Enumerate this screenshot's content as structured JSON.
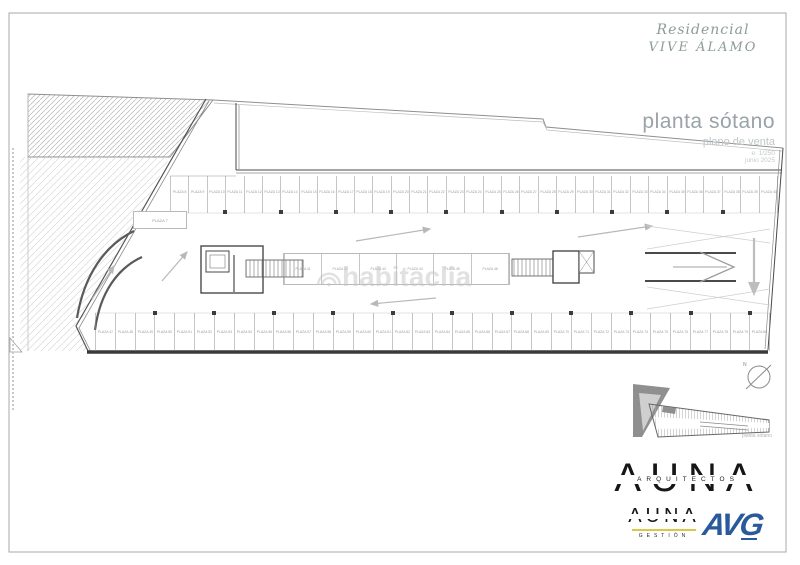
{
  "title_block": {
    "project_line1": "Residencial",
    "project_line2": "VIVE ÁLAMO",
    "plan_title": "planta sótano",
    "plan_subtitle": "plano de venta",
    "scale": "e: 1/250",
    "date": "junio 2025"
  },
  "watermark": {
    "text": "habitaclia"
  },
  "inset": {
    "caption": "planta sótano",
    "north_label": "N"
  },
  "logos": {
    "auna": {
      "name": "AUNA",
      "subtitle": "ARQUITECTOS"
    },
    "auna_gestion": {
      "name": "AUNA",
      "subtitle": "GESTIÓN"
    },
    "avg": {
      "name": "AVG"
    }
  },
  "plan": {
    "single_stall_label": "PLAZA 7",
    "top_row_labels": [
      "PLAZA 8",
      "PLAZA 9",
      "PLAZA 10",
      "PLAZA 11",
      "PLAZA 12",
      "PLAZA 13",
      "PLAZA 14",
      "PLAZA 15",
      "PLAZA 16",
      "PLAZA 17",
      "PLAZA 18",
      "PLAZA 19",
      "PLAZA 20",
      "PLAZA 21",
      "PLAZA 22",
      "PLAZA 23",
      "PLAZA 24",
      "PLAZA 25",
      "PLAZA 26",
      "PLAZA 27",
      "PLAZA 28",
      "PLAZA 29",
      "PLAZA 30",
      "PLAZA 31",
      "PLAZA 32",
      "PLAZA 33",
      "PLAZA 34",
      "PLAZA 35",
      "PLAZA 36",
      "PLAZA 37",
      "PLAZA 38",
      "PLAZA 39",
      "PLAZA 40"
    ],
    "middle_row_labels": [
      "PLAZA 41",
      "PLAZA 42",
      "PLAZA 43",
      "PLAZA 44",
      "PLAZA 45",
      "PLAZA 46"
    ],
    "bottom_row_labels": [
      "PLAZA 47",
      "PLAZA 48",
      "PLAZA 49",
      "PLAZA 50",
      "PLAZA 51",
      "PLAZA 52",
      "PLAZA 53",
      "PLAZA 54",
      "PLAZA 55",
      "PLAZA 56",
      "PLAZA 57",
      "PLAZA 58",
      "PLAZA 59",
      "PLAZA 60",
      "PLAZA 61",
      "PLAZA 62",
      "PLAZA 63",
      "PLAZA 64",
      "PLAZA 65",
      "PLAZA 66",
      "PLAZA 67",
      "PLAZA 68",
      "PLAZA 69",
      "PLAZA 70",
      "PLAZA 71",
      "PLAZA 72",
      "PLAZA 73",
      "PLAZA 74",
      "PLAZA 75",
      "PLAZA 76",
      "PLAZA 77",
      "PLAZA 78",
      "PLAZA 79",
      "PLAZA 80"
    ]
  }
}
